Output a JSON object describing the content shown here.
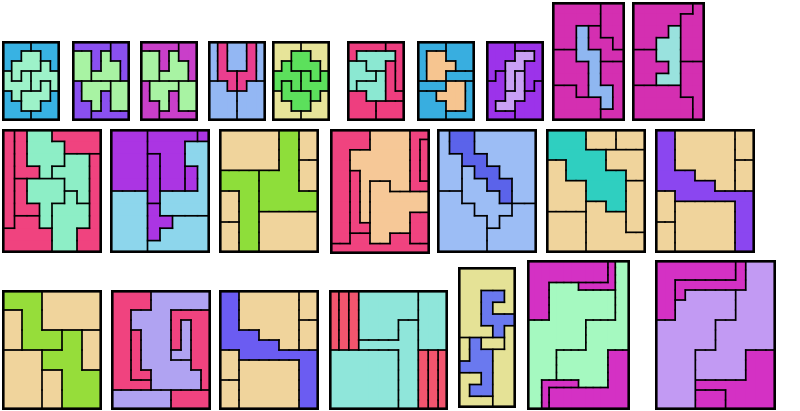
{
  "canvas": {
    "width": 800,
    "height": 411,
    "background": "#ffffff"
  },
  "board": {
    "description": "grid of polyomino rectangle tilings",
    "outline_color": "#000000",
    "inner_border_width": 1.7,
    "outer_border_width": 2.6,
    "puzzle_count": 24
  },
  "puzzles": [
    {
      "id": "puzzle-r1-1",
      "x": 2,
      "y": 41,
      "w": 58,
      "h": 80,
      "colors": {
        "A": "#38b2e3",
        "B": "#38b2e3",
        "C": "#38b2e3",
        "D": "#38b2e3",
        "n": "#9df2c9",
        "e": "#9df2c9",
        "s": "#9df2c9",
        "w": "#9df2c9"
      },
      "grid": [
        "AAABBB",
        "AAnnBB",
        "AnnneB",
        "wnweee",
        "wwwese",
        "CwsssD",
        "CCssDD",
        "CCCDDD"
      ]
    },
    {
      "id": "puzzle-r1-2",
      "x": 72,
      "y": 41,
      "w": 58,
      "h": 80,
      "colors": {
        "a": "#8a50f0",
        "b": "#8a50f0",
        "c": "#8a50f0",
        "d": "#8a50f0",
        "g": "#a8f3a3",
        "h": "#a8f3a3",
        "i": "#a8f3a3",
        "j": "#a8f3a3"
      },
      "grid": [
        "aaaabb",
        "ggahbb",
        "ggahhb",
        "gghhhb",
        "ciiijj",
        "ciidjj",
        "ccidjj",
        "ccdddd"
      ]
    },
    {
      "id": "puzzle-r1-3",
      "x": 140,
      "y": 41,
      "w": 58,
      "h": 80,
      "colors": {
        "a": "#c93fc9",
        "b": "#c93fc9",
        "c": "#c93fc9",
        "d": "#c93fc9",
        "g": "#a8f3a3",
        "h": "#a8f3a3",
        "i": "#a8f3a3",
        "j": "#a8f3a3"
      },
      "grid": [
        "aaaabb",
        "ggahbb",
        "ggahhb",
        "gghhhb",
        "ciiijj",
        "ciidjj",
        "ccidjj",
        "ccdddd"
      ]
    },
    {
      "id": "puzzle-r1-4",
      "x": 208,
      "y": 41,
      "w": 58,
      "h": 80,
      "colors": {
        "A": "#93b7f3",
        "B": "#93b7f3",
        "C": "#93b7f3",
        "D": "#93b7f3",
        "E": "#93b7f3",
        "p": "#ea3e8e",
        "q": "#ea3e8e"
      },
      "grid": [
        "ApBBqC",
        "ApBBqC",
        "ApBBqC",
        "AppqqC",
        "DDpqEE",
        "DDDEEE",
        "DDDEEE",
        "DDDEEE"
      ]
    },
    {
      "id": "puzzle-r1-5",
      "x": 272,
      "y": 41,
      "w": 58,
      "h": 80,
      "colors": {
        "A": "#e7e499",
        "B": "#e7e499",
        "C": "#e7e499",
        "D": "#e7e499",
        "n": "#5ce05c",
        "e": "#5ce05c",
        "s": "#5ce05c",
        "w": "#5ce05c"
      },
      "grid": [
        "BBBAAA",
        "BBnnAA",
        "BennnA",
        "eeewnw",
        "esewww",
        "DssswC",
        "DDssCC",
        "DDDCCC"
      ]
    },
    {
      "id": "puzzle-r1-6",
      "x": 347,
      "y": 41,
      "w": 58,
      "h": 80,
      "colors": {
        "a": "#ee3e7f",
        "b": "#ee3e7f",
        "c": "#ee3e7f",
        "d": "#ee3e7f",
        "e": "#ee3e7f",
        "q": "#8be8d2",
        "r": "#8be8d2",
        "s": "#8be8d2"
      },
      "grid": [
        "aaaabb",
        "aqqqqb",
        "rrqqcb",
        "rrrscb",
        "rssscb",
        "ddsscc",
        "dddeee",
        "dddeee"
      ]
    },
    {
      "id": "puzzle-r1-7",
      "x": 417,
      "y": 41,
      "w": 58,
      "h": 80,
      "colors": {
        "A": "#38aee0",
        "B": "#38aee0",
        "C": "#38aee0",
        "D": "#38aee0",
        "F": "#38aee0",
        "G": "#38aee0",
        "x": "#f6c590",
        "y": "#f6c590"
      },
      "grid": [
        "AAABBB",
        "AxxBBB",
        "AxxxBB",
        "AxxFFF",
        "GGGyyD",
        "CCyyyD",
        "CCCyyD",
        "CCCDDD"
      ]
    },
    {
      "id": "puzzle-r1-8",
      "x": 486,
      "y": 41,
      "w": 58,
      "h": 80,
      "colors": {
        "A": "#9c33ea",
        "B": "#9c33ea",
        "C": "#9c33ea",
        "D": "#9c33ea",
        "x": "#c9a0f5",
        "y": "#c9a0f5"
      },
      "grid": [
        "AAABBB",
        "AAAxxB",
        "AAxxBB",
        "ACxyBB",
        "CCxyBD",
        "CCyyDD",
        "CyyDDD",
        "CCCDDD"
      ]
    },
    {
      "id": "puzzle-r1-9",
      "x": 552,
      "y": 2,
      "w": 73,
      "h": 119,
      "colors": {
        "A": "#d42fb1",
        "B": "#d42fb1",
        "C": "#d42fb1",
        "D": "#d42fb1",
        "E": "#d42fb1",
        "F": "#d42fb1",
        "b": "#8fb7f1"
      },
      "grid": [
        "AAAABB",
        "AAAABB",
        "AAbCBB",
        "AAbCCB",
        "DDbbCC",
        "DDDbEE",
        "DDDbEE",
        "FFDbbE",
        "FFFFbE",
        "FFFFEE"
      ]
    },
    {
      "id": "puzzle-r1-10",
      "x": 632,
      "y": 2,
      "w": 73,
      "h": 119,
      "colors": {
        "A": "#d42fb1",
        "B": "#d42fb1",
        "C": "#d42fb1",
        "E": "#d42fb1",
        "F": "#d42fb1",
        "b": "#99e2de"
      },
      "grid": [
        "AAAAAB",
        "AAAABB",
        "AAAbBB",
        "AAbbBB",
        "CCbbBB",
        "CCCbEE",
        "CCbbEE",
        "FFFFEE",
        "FFFFFE",
        "FFFFFE"
      ]
    },
    {
      "id": "puzzle-r2-1",
      "x": 2,
      "y": 129,
      "w": 100,
      "h": 124,
      "colors": {
        "a": "#f0437f",
        "b": "#f0437f",
        "c": "#f0437f",
        "d": "#f0437f",
        "e": "#f0437f",
        "f": "#f0437f",
        "q": "#8deec6",
        "r": "#8deec6",
        "s": "#8deec6",
        "t": "#8deec6"
      },
      "grid": [
        "abqqcccc",
        "abqqqccc",
        "abqqqrrd",
        "abbqrrrd",
        "aesssrrd",
        "aessstrd",
        "aeestttd",
        "affstttd",
        "ffffttdd",
        "ffffttdd"
      ]
    },
    {
      "id": "puzzle-r2-2",
      "x": 110,
      "y": 129,
      "w": 100,
      "h": 124,
      "colors": {
        "A": "#ab35e3",
        "B": "#ab35e3",
        "C": "#ab35e3",
        "D": "#ab35e3",
        "E": "#ab35e3",
        "F": "#ab35e3",
        "x": "#8dd6ec",
        "y": "#8dd6ec",
        "z": "#8dd6ec"
      },
      "grid": [
        "AAABBBBC",
        "AAABBBxx",
        "AAADBBxx",
        "AAADBBEx",
        "AAADBBEx",
        "yyyDxxxx",
        "yyyFxxxx",
        "yyyFFzzz",
        "yyyFzzzz",
        "yyyzzzzz"
      ]
    },
    {
      "id": "puzzle-r2-3",
      "x": 219,
      "y": 129,
      "w": 100,
      "h": 124,
      "colors": {
        "a": "#f0d49c",
        "b": "#f0d49c",
        "c": "#f0d49c",
        "d": "#f0d49c",
        "e": "#f0d49c",
        "f": "#f0d49c",
        "x": "#8ede3a",
        "y": "#8ede3a"
      },
      "grid": [
        "aaaaaaxxbb",
        "aaaaaaxxbb",
        "aaaaaaxxbb",
        "aaaaaaxxcc",
        "yyyyxxxxcc",
        "yyyyxxxxcc",
        "ddyyxxxxxx",
        "ddyyxxxxxx",
        "ddyyffffff",
        "eeyyffffff",
        "eeyyffffff",
        "eeyyffffff"
      ]
    },
    {
      "id": "puzzle-r2-4",
      "x": 330,
      "y": 129,
      "w": 100,
      "h": 125,
      "colors": {
        "a": "#f0437f",
        "b": "#f0437f",
        "c": "#f0437f",
        "s": "#f0437f",
        "d": "#f0437f",
        "e": "#f0437f",
        "x": "#f6c897",
        "y": "#f6c897"
      },
      "grid": [
        "aaaaxxxxcc",
        "aaaaxxxxcs",
        "aaxxxxxxcs",
        "aaxxxxxxcs",
        "aabxxxxxcs",
        "aabxyyxxcc",
        "aabxyyyyyy",
        "aabxyyyyyy",
        "aabxyyyydd",
        "aabbyyyydd",
        "aaeeyyeedd",
        "eeeeeeeeee"
      ]
    },
    {
      "id": "puzzle-r2-5",
      "x": 437,
      "y": 129,
      "w": 100,
      "h": 124,
      "colors": {
        "A": "#9cbdf5",
        "B": "#9cbdf5",
        "C": "#9cbdf5",
        "D": "#9cbdf5",
        "E": "#9cbdf5",
        "r": "#5b63ea"
      },
      "grid": [
        "ArrBBBBB",
        "ArrBBBBB",
        "AArrBBBB",
        "AACrrBBB",
        "AACCrrBB",
        "DDCCCrBB",
        "DDDCCCEE",
        "DDDDCEEE",
        "DDDDEEEE",
        "DDDDEEEE"
      ]
    },
    {
      "id": "puzzle-r2-6",
      "x": 546,
      "y": 129,
      "w": 100,
      "h": 124,
      "colors": {
        "a": "#f0d49c",
        "b": "#f0d49c",
        "c": "#f0d49c",
        "d": "#f0d49c",
        "e": "#f0d49c",
        "f": "#f0d49c",
        "g": "#f0d49c",
        "x": "#2fcfc0"
      },
      "grid": [
        "xxxxaaabbb",
        "xxxxaaabbb",
        "xxxxxxcccc",
        "ddxxxxcccc",
        "ddxxxxxxcc",
        "ddddxxxxee",
        "ddddxxxxee",
        "ddddffxxee",
        "ggggffffee",
        "ggggffffee",
        "ggggffffff",
        "ggggffffff"
      ]
    },
    {
      "id": "puzzle-r2-7",
      "x": 655,
      "y": 129,
      "w": 100,
      "h": 124,
      "colors": {
        "p": "#8b46f0",
        "a": "#f0d49c",
        "b": "#f0d49c",
        "c": "#f0d49c",
        "d": "#f0d49c",
        "e": "#f0d49c",
        "f": "#f0d49c"
      },
      "grid": [
        "ppaaaaaabb",
        "ppaaaaaabb",
        "ppaaaaaabb",
        "ppaaaaaacc",
        "ppppaaaacc",
        "ppppppaacc",
        "ddpppppppp",
        "ddeeeeeepp",
        "ddeeeeeepp",
        "ffeeeeeepp",
        "ffeeeeeepp",
        "ffeeeeeepp"
      ]
    },
    {
      "id": "puzzle-r3-1",
      "x": 2,
      "y": 290,
      "w": 100,
      "h": 120,
      "colors": {
        "a": "#f0d49c",
        "b": "#f0d49c",
        "c": "#f0d49c",
        "d": "#f0d49c",
        "e": "#f0d49c",
        "x": "#96dd3a",
        "y": "#96dd3a"
      },
      "grid": [
        "xxaaa",
        "bxaaa",
        "bxxyc",
        "ddyyc",
        "ddeyy",
        "ddeyy"
      ]
    },
    {
      "id": "puzzle-r3-2",
      "x": 111,
      "y": 290,
      "w": 100,
      "h": 120,
      "colors": {
        "a": "#f0437f",
        "b": "#f0437f",
        "c": "#f0437f",
        "e": "#f0437f",
        "x": "#b0a3f2",
        "y": "#b0a3f2",
        "z": "#b0a3f2"
      },
      "grid": [
        "aaaaxxxxxx",
        "aaaaxxxxxx",
        "aaxxxxcccc",
        "aaxxxxcycc",
        "aabxxxcycc",
        "aabxxxcycc",
        "aabxxxyycc",
        "aabxxxxxcc",
        "aabbxxxxxc",
        "aaaaxxxxxc",
        "zzzzzzeeee",
        "zzzzzzeeee"
      ]
    },
    {
      "id": "puzzle-r3-3",
      "x": 219,
      "y": 290,
      "w": 100,
      "h": 120,
      "colors": {
        "p": "#6b5cf2",
        "a": "#f0d49c",
        "b": "#f0d49c",
        "c": "#f0d49c",
        "d": "#f0d49c",
        "e": "#f0d49c",
        "f": "#f0d49c"
      },
      "grid": [
        "ppaaaaaabb",
        "ppaaaaaabb",
        "ppaaaaaabb",
        "ppaaaaaacc",
        "ppppaaaacc",
        "ppppppaacc",
        "ddpppppppp",
        "ddeeeeeepp",
        "ddeeeeeepp",
        "ffeeeeeepp",
        "ffeeeeeepp",
        "ffeeeeeepp"
      ]
    },
    {
      "id": "puzzle-r3-4",
      "x": 329,
      "y": 290,
      "w": 119,
      "h": 120,
      "colors": {
        "r": "#f2556e",
        "s": "#f2556e",
        "t": "#f2556e",
        "u": "#f2556e",
        "v": "#f2556e",
        "w": "#f2556e",
        "a": "#8fe6da",
        "b": "#8fe6da",
        "c": "#8fe6da",
        "d": "#8fe6da"
      },
      "grid": [
        "rstaaaaaabbb",
        "rstaaaaaabbb",
        "rstaaaaaabbb",
        "rstaaaaccbbb",
        "rstaaaaccbbb",
        "rstccccccbbb",
        "dddddddccuvw",
        "dddddddccuvw",
        "dddddddccuvw",
        "dddddddccuvw",
        "dddddddccuvw",
        "dddddddccuvw"
      ]
    },
    {
      "id": "puzzle-r3-5",
      "x": 458,
      "y": 267,
      "w": 58,
      "h": 141,
      "colors": {
        "a": "#e5e296",
        "b": "#e5e296",
        "c": "#e5e296",
        "x": "#6a79ef",
        "y": "#6a79ef"
      },
      "grid": [
        "aaaaa",
        "aaaaa",
        "aaxxa",
        "aaxaa",
        "aaxxx",
        "aaaxb",
        "cyccb",
        "cyybb",
        "yyybb",
        "ccybb",
        "cyybb",
        "cccbb"
      ]
    },
    {
      "id": "puzzle-r3-6",
      "x": 527,
      "y": 260,
      "w": 103,
      "h": 150,
      "colors": {
        "A": "#d431c4",
        "B": "#d431c4",
        "C": "#d431c4",
        "D": "#d431c4",
        "m": "#a5f9c0",
        "n": "#a5f9c0"
      },
      "grid": [
        "AAAAAAAAAAABnn",
        "AAAAAAAAAAABnn",
        "AAAAAAAAAAABnn",
        "AAAmmmmBBBBBnn",
        "AAAmmmmmmmmmnn",
        "AAAmmmmmmmmmnn",
        "AAAmmmmmmmmmnn",
        "AAAmmmmmmmmmnn",
        "mmmmmmmmnnnnnn",
        "mmmmmmmmnnnnnn",
        "mmmmmmmmnnnnnn",
        "mmmmmmmmnnnnnn",
        "mmmmnnnnnnnCCC",
        "mmmmnnnnnnnCCC",
        "mmmmnnnnnnnCCC",
        "mmmmnnnnnnnCCC",
        "mmDDDDDnnnnCCC",
        "mmDCCCCCCCCCCC",
        "mmDCCCCCCCCCCC",
        "mmDCCCCCCCCCCC"
      ]
    },
    {
      "id": "puzzle-r3-7",
      "x": 655,
      "y": 260,
      "w": 121,
      "h": 150,
      "colors": {
        "A": "#d431c4",
        "B": "#d431c4",
        "C": "#d431c4",
        "D": "#d431c4",
        "m": "#c29af3",
        "n": "#c29af3"
      },
      "grid": [
        "AAAAAAAABnnn",
        "AAAAAAAABnnn",
        "AABBBBBBBnnn",
        "AABmmmmmnnnn",
        "AAmmmmmmnnnn",
        "AAmmmmmmnnnn",
        "mmmmmmnnnnnn",
        "mmmmmmnnnnnn",
        "mmmmmmnnnnnn",
        "mmmmnnnnnCCC",
        "mmmmnnnnnCCC",
        "mmmmnnnnnCCC",
        "mmmmCCCCCCCC",
        "mmmmDDDCCCCC",
        "mmmmDDDCCCCC"
      ]
    }
  ]
}
